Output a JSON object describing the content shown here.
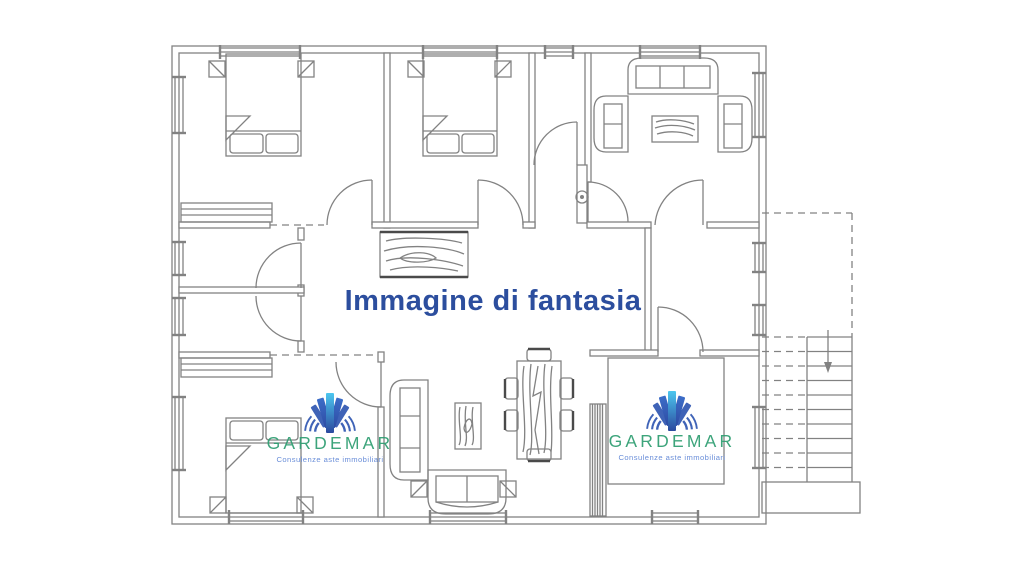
{
  "watermark": {
    "disclaimer": "Immagine di fantasia",
    "disclaimer_color": "#2c4e9e"
  },
  "brand": {
    "name": "GARDEMAR",
    "tagline": "Consulenze aste immobiliari",
    "name_color": "#2f9e72",
    "tagline_color": "#5f86d6",
    "fan_icon": "gardemar-fan-logo",
    "fan_colors": {
      "center_top": "#3fc3ee",
      "center_bottom": "#1c3c98",
      "inner_top": "#2e62c4",
      "inner_bottom": "#1e3f9d",
      "outer_bars_and_waves": "#3158b2"
    }
  },
  "plan": {
    "line_color": "#828282",
    "dark_accent_color": "#4a4a4a",
    "background": "#ffffff"
  }
}
